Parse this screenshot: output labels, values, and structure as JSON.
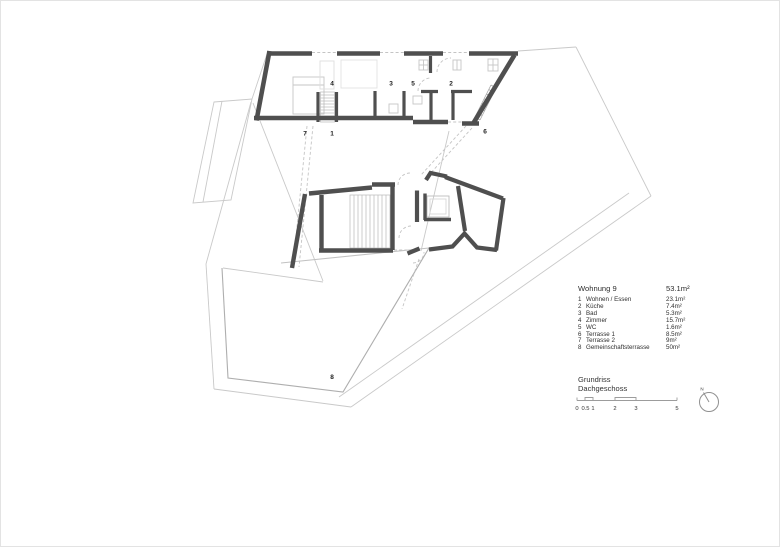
{
  "legend": {
    "title": "Wohnung 9",
    "title_area": "53.1m²",
    "items": [
      {
        "num": "1",
        "label": "Wohnen / Essen",
        "area": "23.1m²"
      },
      {
        "num": "2",
        "label": "Küche",
        "area": "7.4m²"
      },
      {
        "num": "3",
        "label": "Bad",
        "area": "5.3m²"
      },
      {
        "num": "4",
        "label": "Zimmer",
        "area": "15.7m²"
      },
      {
        "num": "5",
        "label": "WC",
        "area": "1.6m²"
      },
      {
        "num": "6",
        "label": "Terrasse 1",
        "area": "8.5m²"
      },
      {
        "num": "7",
        "label": "Terrasse 2",
        "area": "9m²"
      },
      {
        "num": "8",
        "label": "Gemeinschaftsterrasse",
        "area": "50m²"
      }
    ]
  },
  "titleblock": {
    "line1": "Grundriss",
    "line2": "Dachgeschoss",
    "scale_ticks": [
      "0",
      "0.5",
      "1",
      "2",
      "3",
      "5"
    ]
  },
  "north_label": "N",
  "plan_labels": [
    "4",
    "3",
    "5",
    "2",
    "7",
    "1",
    "6",
    "8"
  ],
  "colors": {
    "wall": "#4f4f4f",
    "roof_line": "#c9c9c9",
    "terrace_line": "#aeaeae",
    "hatch": "#b8b8b8",
    "fixture": "#c6c6c6",
    "dash": "#c4c4c4"
  }
}
